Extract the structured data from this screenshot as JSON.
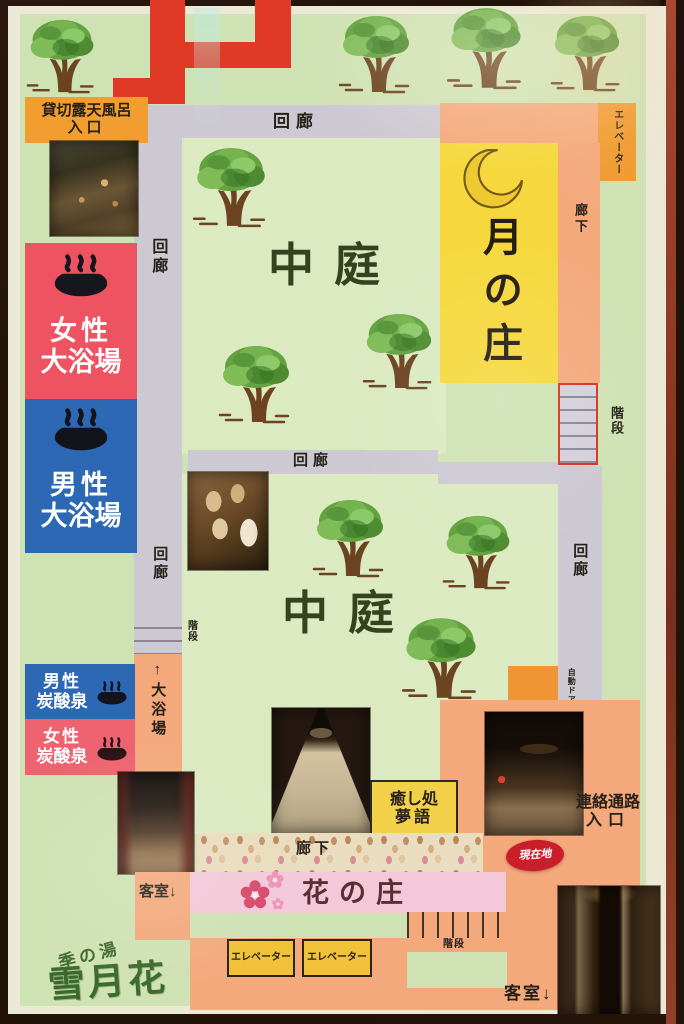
{
  "logo": {
    "prefix": "季の湯",
    "name": "雪月花"
  },
  "wings": {
    "moon": "月の庄",
    "flower": "花の庄",
    "courtyard": "中庭"
  },
  "baths": {
    "private_open_air_l1": "貸切露天風呂",
    "private_open_air_l2": "入口",
    "women_large_l1": "女性",
    "women_large_l2": "大浴場",
    "men_large_l1": "男性",
    "men_large_l2": "大浴場",
    "men_carbonated_l1": "男性",
    "men_carbonated_l2": "炭酸泉",
    "women_carbonated_l1": "女性",
    "women_carbonated_l2": "炭酸泉"
  },
  "facilities": {
    "healing_l1": "癒し処",
    "healing_l2": "夢語",
    "connecting_l1": "連絡通路",
    "connecting_l2": "入口"
  },
  "wayfinding": {
    "kairo": "回廊",
    "rouka": "廊下",
    "elevator": "エレベーター",
    "stairs": "階段",
    "to_large_bath": "↑大浴場",
    "auto_door": "自動ドア",
    "guest_rooms": "客室↓",
    "current_location": "現在地"
  },
  "colors": {
    "map_bg": "#cfe2b4",
    "courtyard_bg": "#dbeac1",
    "corridor_gray": "#cdc9d3",
    "corridor_salmon": "#f4a97d",
    "label_orange": "#f29d2f",
    "moon_wing_yellow": "#f6d83e",
    "flower_wing_pink": "#f3c9da",
    "women_bath_red": "#ee5361",
    "men_bath_blue": "#2c68b3",
    "red_path": "#e03a26",
    "current_location_red": "#ca1f2b",
    "elevator_yellow": "#f1c237",
    "logo_green": "#3c6a2c"
  }
}
